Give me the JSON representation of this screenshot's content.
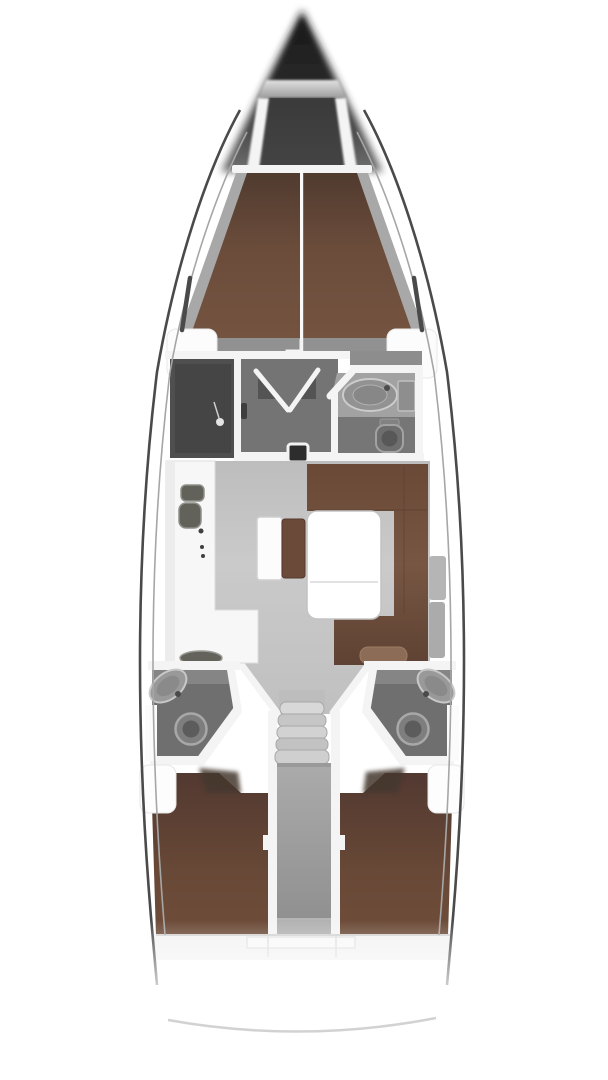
{
  "figure": {
    "kind": "sailing-yacht-interior-floor-plan",
    "view": "top-down",
    "orientation": "bow-up"
  },
  "colors": {
    "bg": "#ffffff",
    "hull_line": "#4a4a4a",
    "deck_line": "#a6a6a6",
    "wall": "#f4f4f4",
    "bow_dark": "#191919",
    "floor_salon": "#c5c5c5",
    "floor_dressing": "#747474",
    "floor_head": "#6f6f6f",
    "floor_corridor": "#9e9e9e",
    "shower_dark": "#494949",
    "wood_fwd": "#6b4c3b",
    "wood_fwd_dark": "#503b2f",
    "wood_settee": "#775643",
    "wood_settee_dark": "#5f4233",
    "wood_aft": "#684836",
    "wood_aft_dark": "#523931",
    "wood_bench": "#6b4a39",
    "fixture": "#929292",
    "fixture_dark": "#585858",
    "step_light": "#d6d6d6",
    "step_mid": "#c2c2c2",
    "table": "#ffffff"
  },
  "regions": {
    "bow": {
      "name": "bow-anchor-locker"
    },
    "fwd_cabin": {
      "name": "forward-cabin-double-berth"
    },
    "dressing": {
      "name": "forward-dressing-area"
    },
    "shower": {
      "name": "port-shower-room"
    },
    "fwd_head": {
      "name": "starboard-forward-head"
    },
    "galley": {
      "name": "port-galley"
    },
    "salon": {
      "name": "salon"
    },
    "table": {
      "name": "salon-table"
    },
    "settee": {
      "name": "l-shaped-settee"
    },
    "bench": {
      "name": "salon-bench-seat"
    },
    "island": {
      "name": "salon-chest-seat"
    },
    "steps": {
      "name": "companionway-steps"
    },
    "aft_head_port": {
      "name": "port-aft-head"
    },
    "aft_head_stbd": {
      "name": "starboard-aft-head"
    },
    "aft_cabin_port": {
      "name": "port-aft-cabin-berth"
    },
    "aft_cabin_stbd": {
      "name": "starboard-aft-cabin-berth"
    },
    "corridor": {
      "name": "engine-compartment-corridor"
    },
    "stern": {
      "name": "stern-transom"
    }
  }
}
